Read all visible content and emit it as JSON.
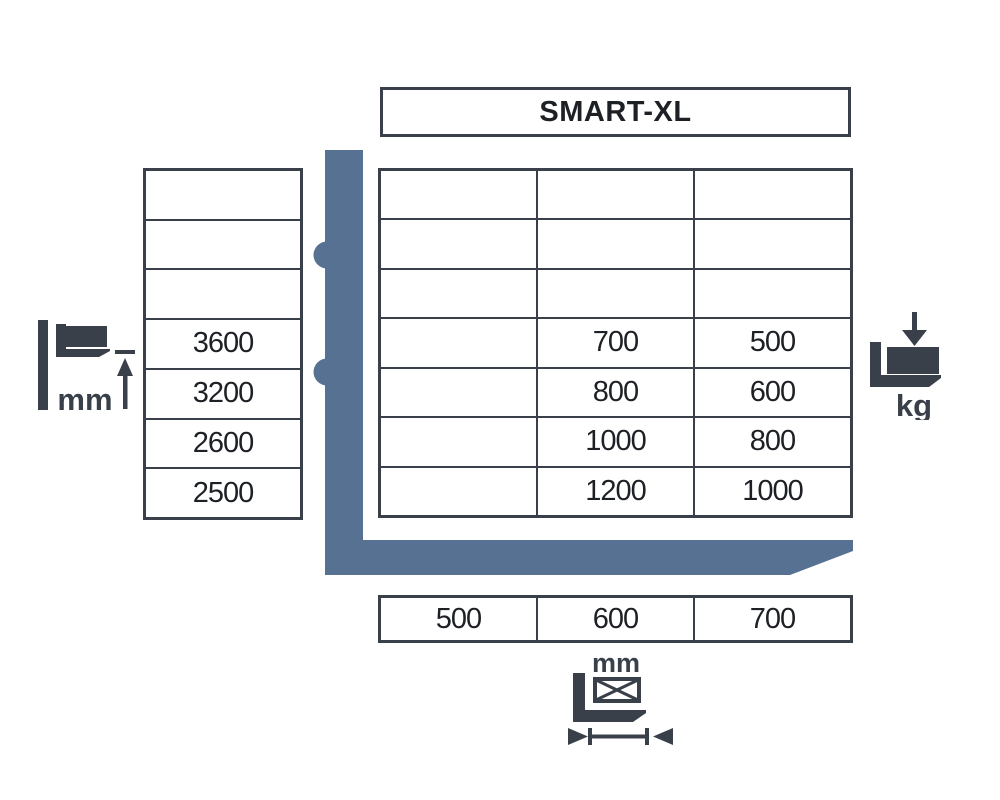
{
  "title": "SMART-XL",
  "colors": {
    "border": "#394049",
    "icon_dark": "#394049",
    "fork_blue": "#567191",
    "text": "#1d2025"
  },
  "lift_height_table": {
    "unit": "mm",
    "rows": [
      "",
      "",
      "",
      "3600",
      "3200",
      "2600",
      "2500"
    ]
  },
  "capacity_table": {
    "unit": "kg",
    "rows": [
      [
        "",
        "",
        ""
      ],
      [
        "",
        "",
        ""
      ],
      [
        "",
        "",
        ""
      ],
      [
        "",
        "700",
        "500"
      ],
      [
        "",
        "800",
        "600"
      ],
      [
        "",
        "1000",
        "800"
      ],
      [
        "",
        "1200",
        "1000"
      ]
    ]
  },
  "load_center_table": {
    "unit": "mm",
    "cells": [
      "500",
      "600",
      "700"
    ]
  },
  "icons": {
    "lift_height_label": "mm",
    "capacity_label": "kg",
    "load_length_label": "mm"
  },
  "chart_data": {
    "type": "table",
    "title": "SMART-XL",
    "lift_height_mm": [
      3600,
      3200,
      2600,
      2500
    ],
    "load_center_mm": [
      500,
      600,
      700
    ],
    "capacity_kg_rows": [
      [
        null,
        700,
        500
      ],
      [
        null,
        800,
        600
      ],
      [
        null,
        1000,
        800
      ],
      [
        null,
        1200,
        1000
      ]
    ],
    "notes": "Rows = lift height (mm, left table), columns = load centre (mm, bottom table), cells = capacity (kg); first column and top three rows empty"
  }
}
